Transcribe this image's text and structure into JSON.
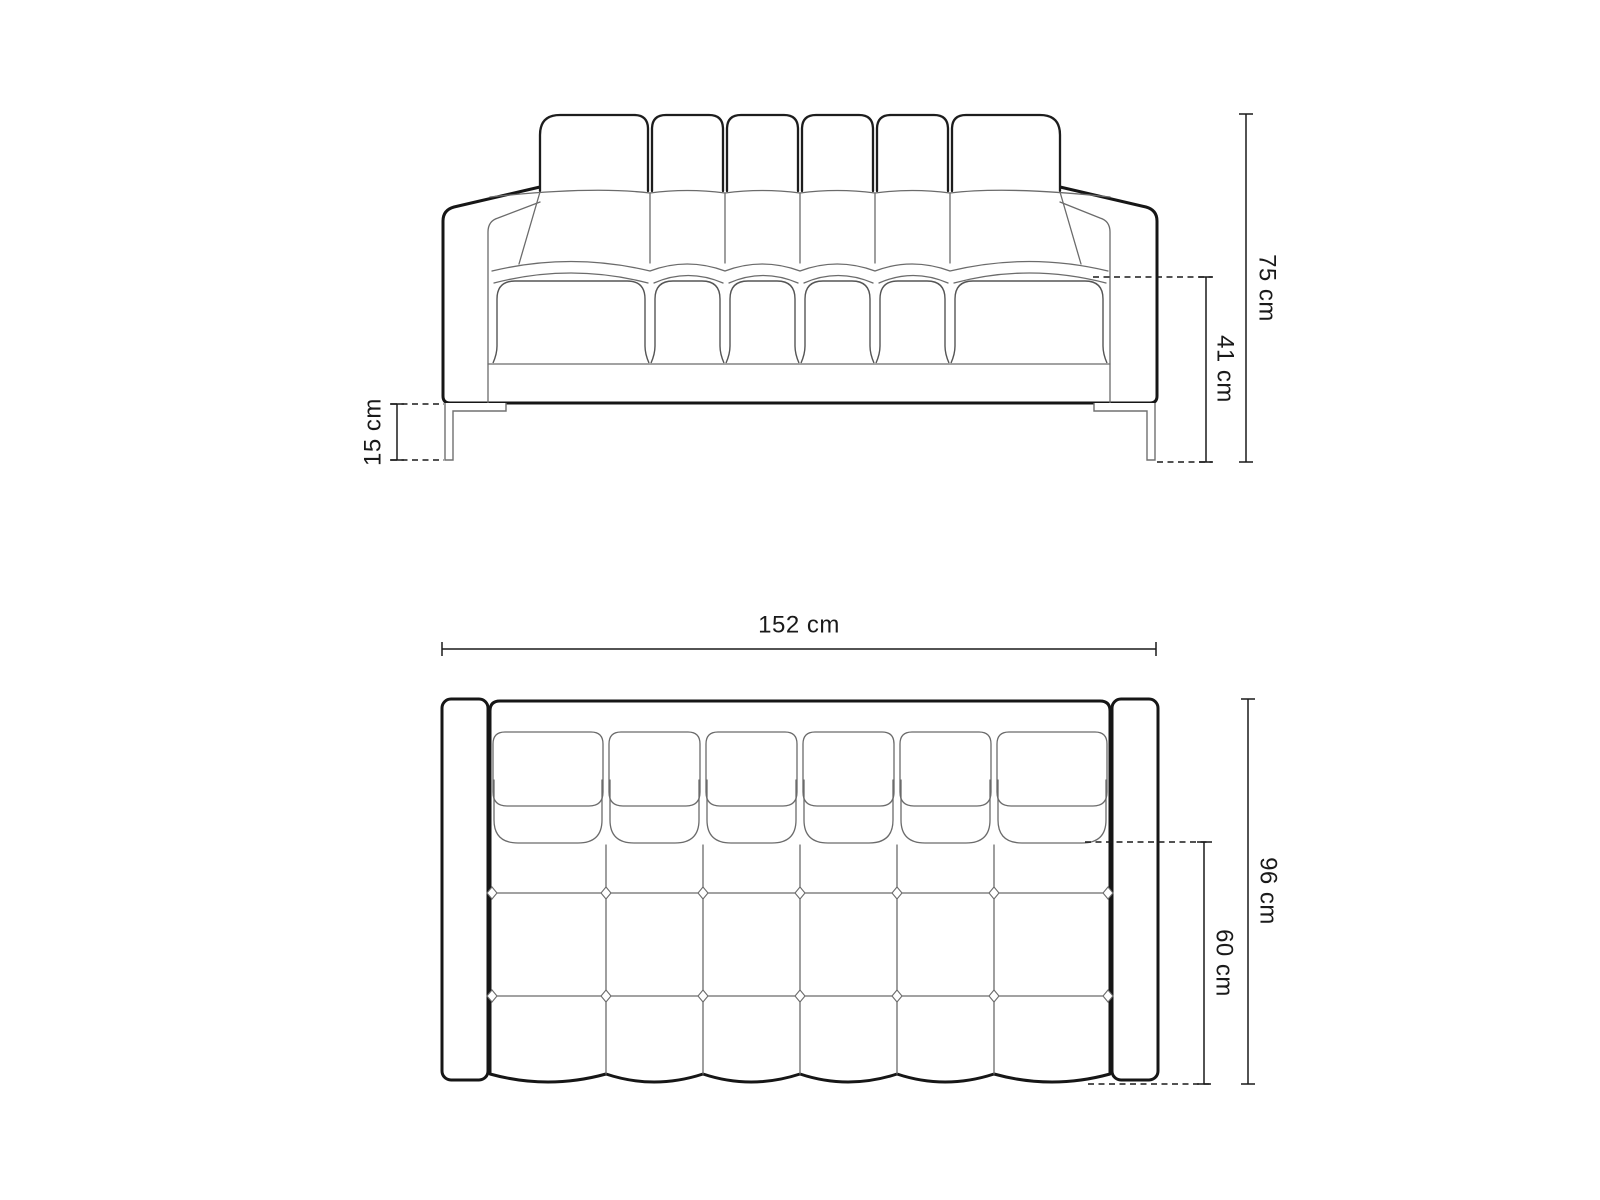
{
  "diagram": {
    "type": "furniture-dimension-drawing",
    "subject": "two-seat tufted sofa, front elevation and top plan",
    "colors": {
      "background": "#ffffff",
      "outline": "#161616",
      "detail_line": "#6b6b6b",
      "dimension_line": "#1a1a1a",
      "label_text": "#1a1a1a"
    },
    "front_view": {
      "dimensions": [
        {
          "id": "total_height",
          "label": "75 cm"
        },
        {
          "id": "seat_height",
          "label": "41 cm"
        },
        {
          "id": "leg_height",
          "label": "15 cm"
        }
      ]
    },
    "top_view": {
      "dimensions": [
        {
          "id": "total_width",
          "label": "152 cm"
        },
        {
          "id": "total_depth",
          "label": "96 cm"
        },
        {
          "id": "seat_depth",
          "label": "60 cm"
        }
      ]
    }
  }
}
